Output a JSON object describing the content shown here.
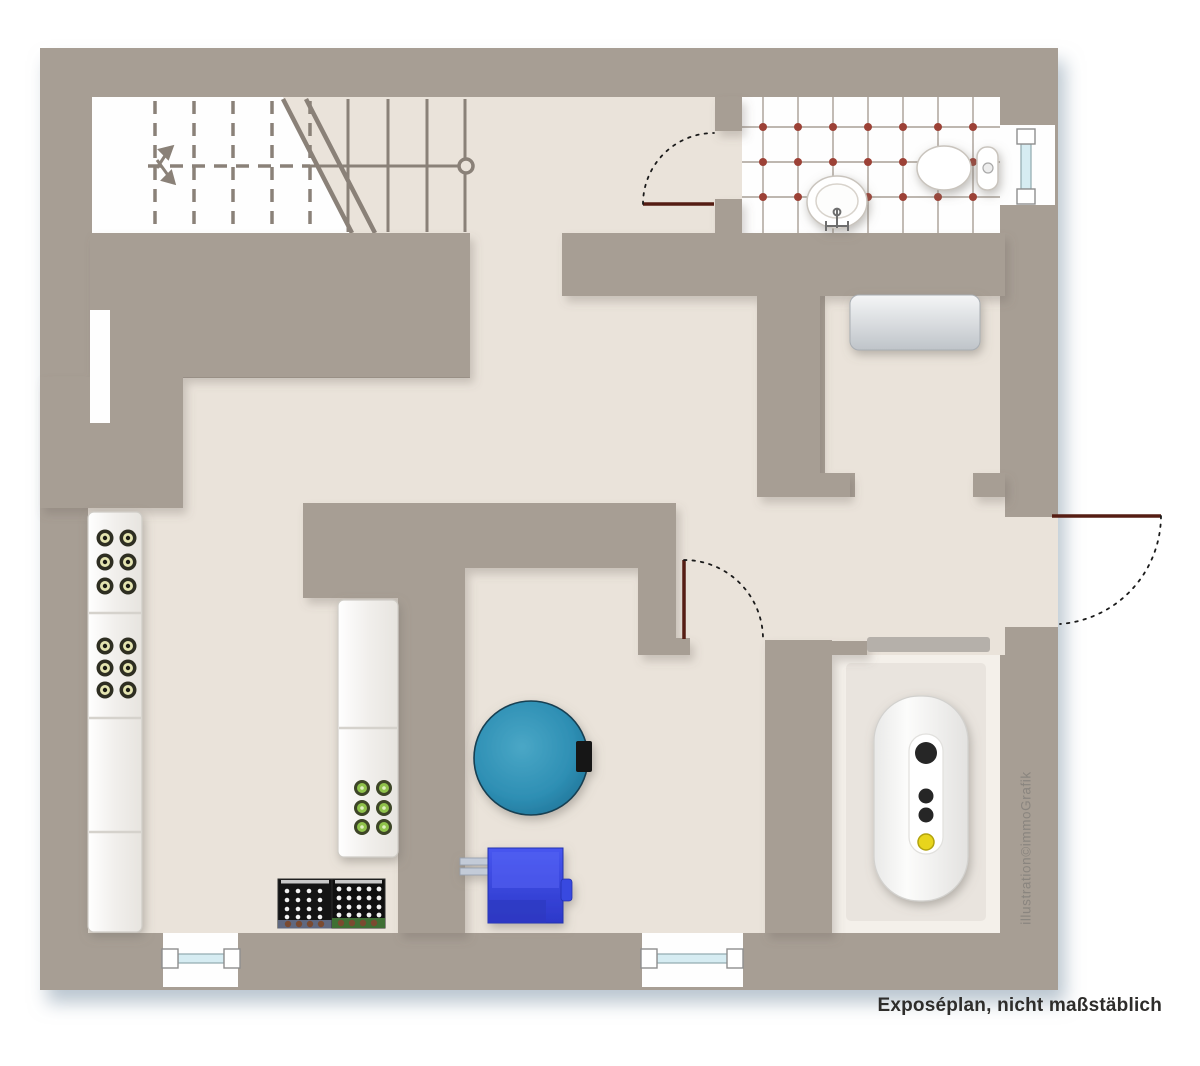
{
  "caption": "Exposéplan, nicht maßstäblich",
  "watermark": "illustration©immoGrafik",
  "colors": {
    "background": "#ffffff",
    "wall": "#a79e94",
    "floor": "#eae3da",
    "floor_light": "#f4f0ea",
    "stairwell": "#fefefe",
    "stair_stroke": "#8a8178",
    "tile_grout": "#a89f96",
    "tile_dot": "#9c4136",
    "door_leaf": "#551d13",
    "swing_arc": "#1a1a1a",
    "window_glass": "#d6ecf2",
    "window_frame": "#8fa9ae",
    "bottle_olive": "#e4e4b0",
    "bottle_green": "#8fc24c",
    "crate_black": "#141414",
    "crate_blue_strip": "#5f6880",
    "crate_green_strip": "#3f6f34",
    "tank_teal": "#2e8fb4",
    "boiler_blue": "#3d4ce8",
    "panel_yellow": "#e8d51f",
    "chest_gray": "#c8ccd0",
    "lintel_gray": "#b5b0aa",
    "shadow": "#c2cdd6",
    "text": "#2e2d2b",
    "watermark_color": "#8a857f"
  },
  "fixtures": [
    "staircase",
    "stair-direction-arrows",
    "bathroom-tiles",
    "washbasin",
    "toilet",
    "entry-door-swing",
    "bathroom-door-swing",
    "room-door-swing",
    "window",
    "wine-rack",
    "bottle-rack",
    "bottle-crates",
    "water-tank",
    "boiler",
    "heating-unit",
    "storage-chest"
  ]
}
